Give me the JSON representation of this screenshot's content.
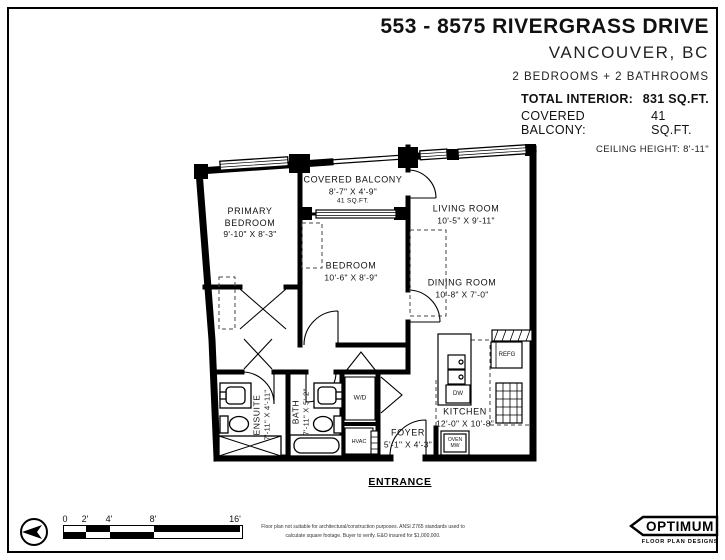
{
  "header": {
    "title": "553 - 8575 RIVERGRASS DRIVE",
    "city": "VANCOUVER, BC",
    "beds_baths": "2 BEDROOMS + 2 BATHROOMS",
    "total_interior_label": "TOTAL INTERIOR:",
    "total_interior_value": "831 SQ.FT.",
    "covered_balcony_label": "COVERED BALCONY:",
    "covered_balcony_value": "41 SQ.FT.",
    "ceiling_height": "CEILING HEIGHT: 8'-11\""
  },
  "plan": {
    "rooms": {
      "primary_bedroom": {
        "name": "PRIMARY BEDROOM",
        "dims": "9'-10\" X 8'-3\""
      },
      "covered_balcony": {
        "name": "COVERED BALCONY",
        "dims": "8'-7\" X 4'-9\"",
        "area": "41 SQ.FT."
      },
      "living_room": {
        "name": "LIVING ROOM",
        "dims": "10'-5\" X 9'-11\""
      },
      "bedroom": {
        "name": "BEDROOM",
        "dims": "10'-6\" X 8'-9\""
      },
      "dining_room": {
        "name": "DINING ROOM",
        "dims": "10'-8\" X 7'-0\""
      },
      "kitchen": {
        "name": "KITCHEN",
        "dims": "12'-0\" X 10'-8\""
      },
      "foyer": {
        "name": "FOYER",
        "dims": "5'-1\" X 4'-3\""
      },
      "ensuite": {
        "name": "ENSUITE",
        "dims": "7'-11\" X 4'-11\""
      },
      "bath": {
        "name": "BATH",
        "dims": "7'-11\" X 5'-2\""
      }
    },
    "labels": {
      "wd": "W/D",
      "hvac": "HVAC",
      "refg": "REFG",
      "dw": "DW",
      "oven": "OVEN",
      "mw": "MW"
    },
    "entrance": "ENTRANCE"
  },
  "footer": {
    "scale_ticks": [
      "0",
      "2'",
      "4'",
      "8'",
      "16'"
    ],
    "disclaimer_line1": "Floor plan not suitable for architectural/construction purposes. ANSI Z765 standards used to",
    "disclaimer_line2": "calculate square footage. Buyer to verify.  E&O insured for $1,000,000.",
    "logo_name": "OPTIMUM",
    "logo_sub": "FLOOR PLAN DESIGNS"
  },
  "colors": {
    "wall": "#000000",
    "text": "#111111",
    "background": "#ffffff"
  }
}
